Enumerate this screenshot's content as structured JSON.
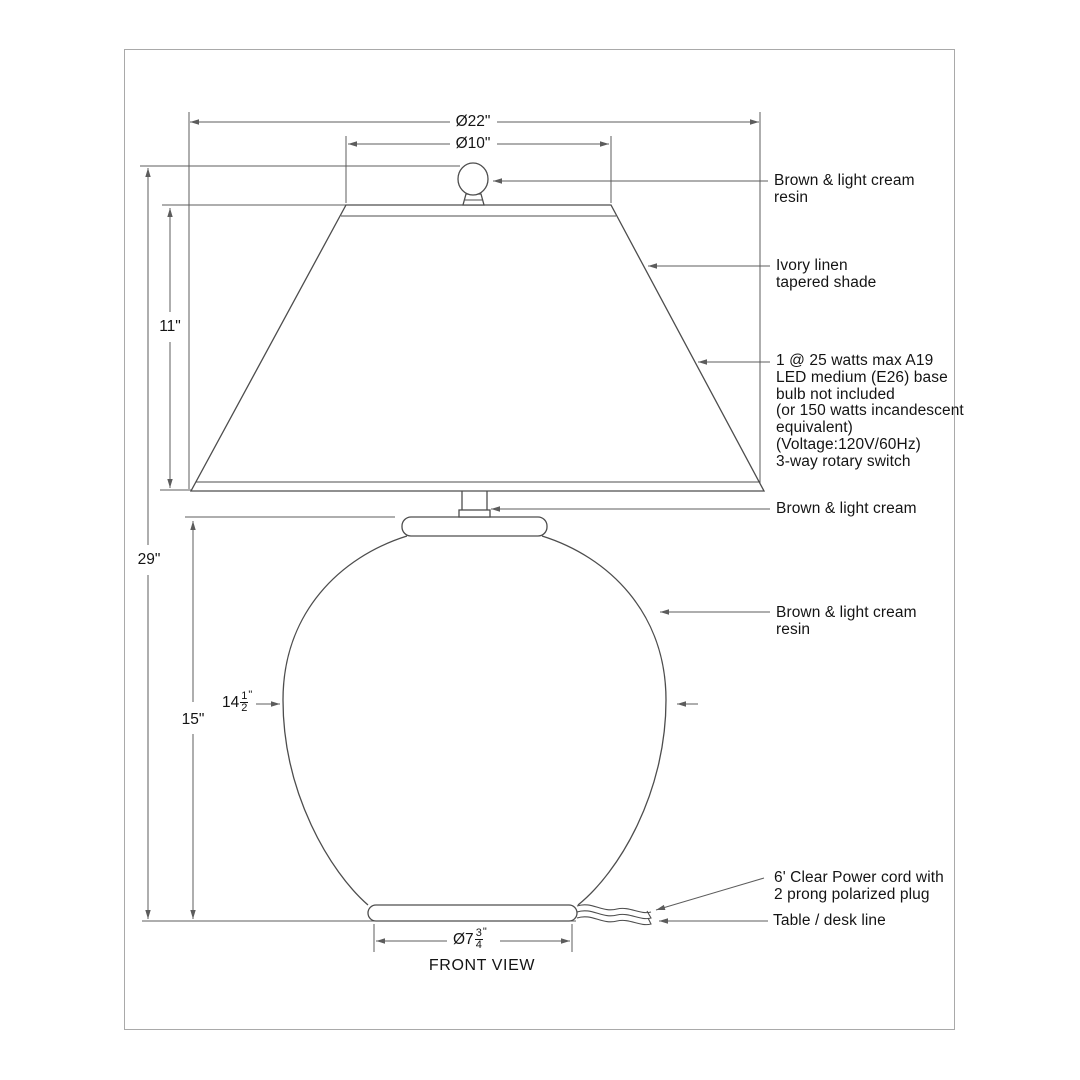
{
  "page": {
    "background": "#ffffff",
    "border_color": "#a9a9a9"
  },
  "colors": {
    "object_line": "#4d4d4d",
    "dimension_line": "#5c5c5c",
    "text": "#141414"
  },
  "view_label": "FRONT VIEW",
  "dimensions": {
    "shade_bottom_diameter": "Ø22\"",
    "shade_top_diameter": "Ø10\"",
    "shade_height": "11\"",
    "overall_height": "29\"",
    "body_height": "15\"",
    "body_width": {
      "whole": "14",
      "numerator": "1",
      "denominator": "2",
      "unit": "\""
    },
    "base_diameter": {
      "whole": "Ø7",
      "numerator": "3",
      "denominator": "4",
      "unit": "\""
    }
  },
  "annotations": {
    "finial": {
      "lines": [
        "Brown & light cream",
        "resin"
      ]
    },
    "shade": {
      "lines": [
        "Ivory linen",
        "tapered shade"
      ]
    },
    "bulb": {
      "lines": [
        "1 @ 25 watts max A19",
        "LED medium (E26) base",
        "bulb not included",
        "(or 150 watts incandescent",
        "equivalent)",
        "(Voltage:120V/60Hz)",
        "3-way rotary switch"
      ]
    },
    "neck": {
      "lines": [
        "Brown & light cream"
      ]
    },
    "body": {
      "lines": [
        "Brown & light cream",
        "resin"
      ]
    },
    "cord": {
      "lines": [
        "6' Clear Power cord with",
        "2 prong polarized plug"
      ]
    },
    "table": {
      "lines": [
        "Table / desk line"
      ]
    }
  }
}
